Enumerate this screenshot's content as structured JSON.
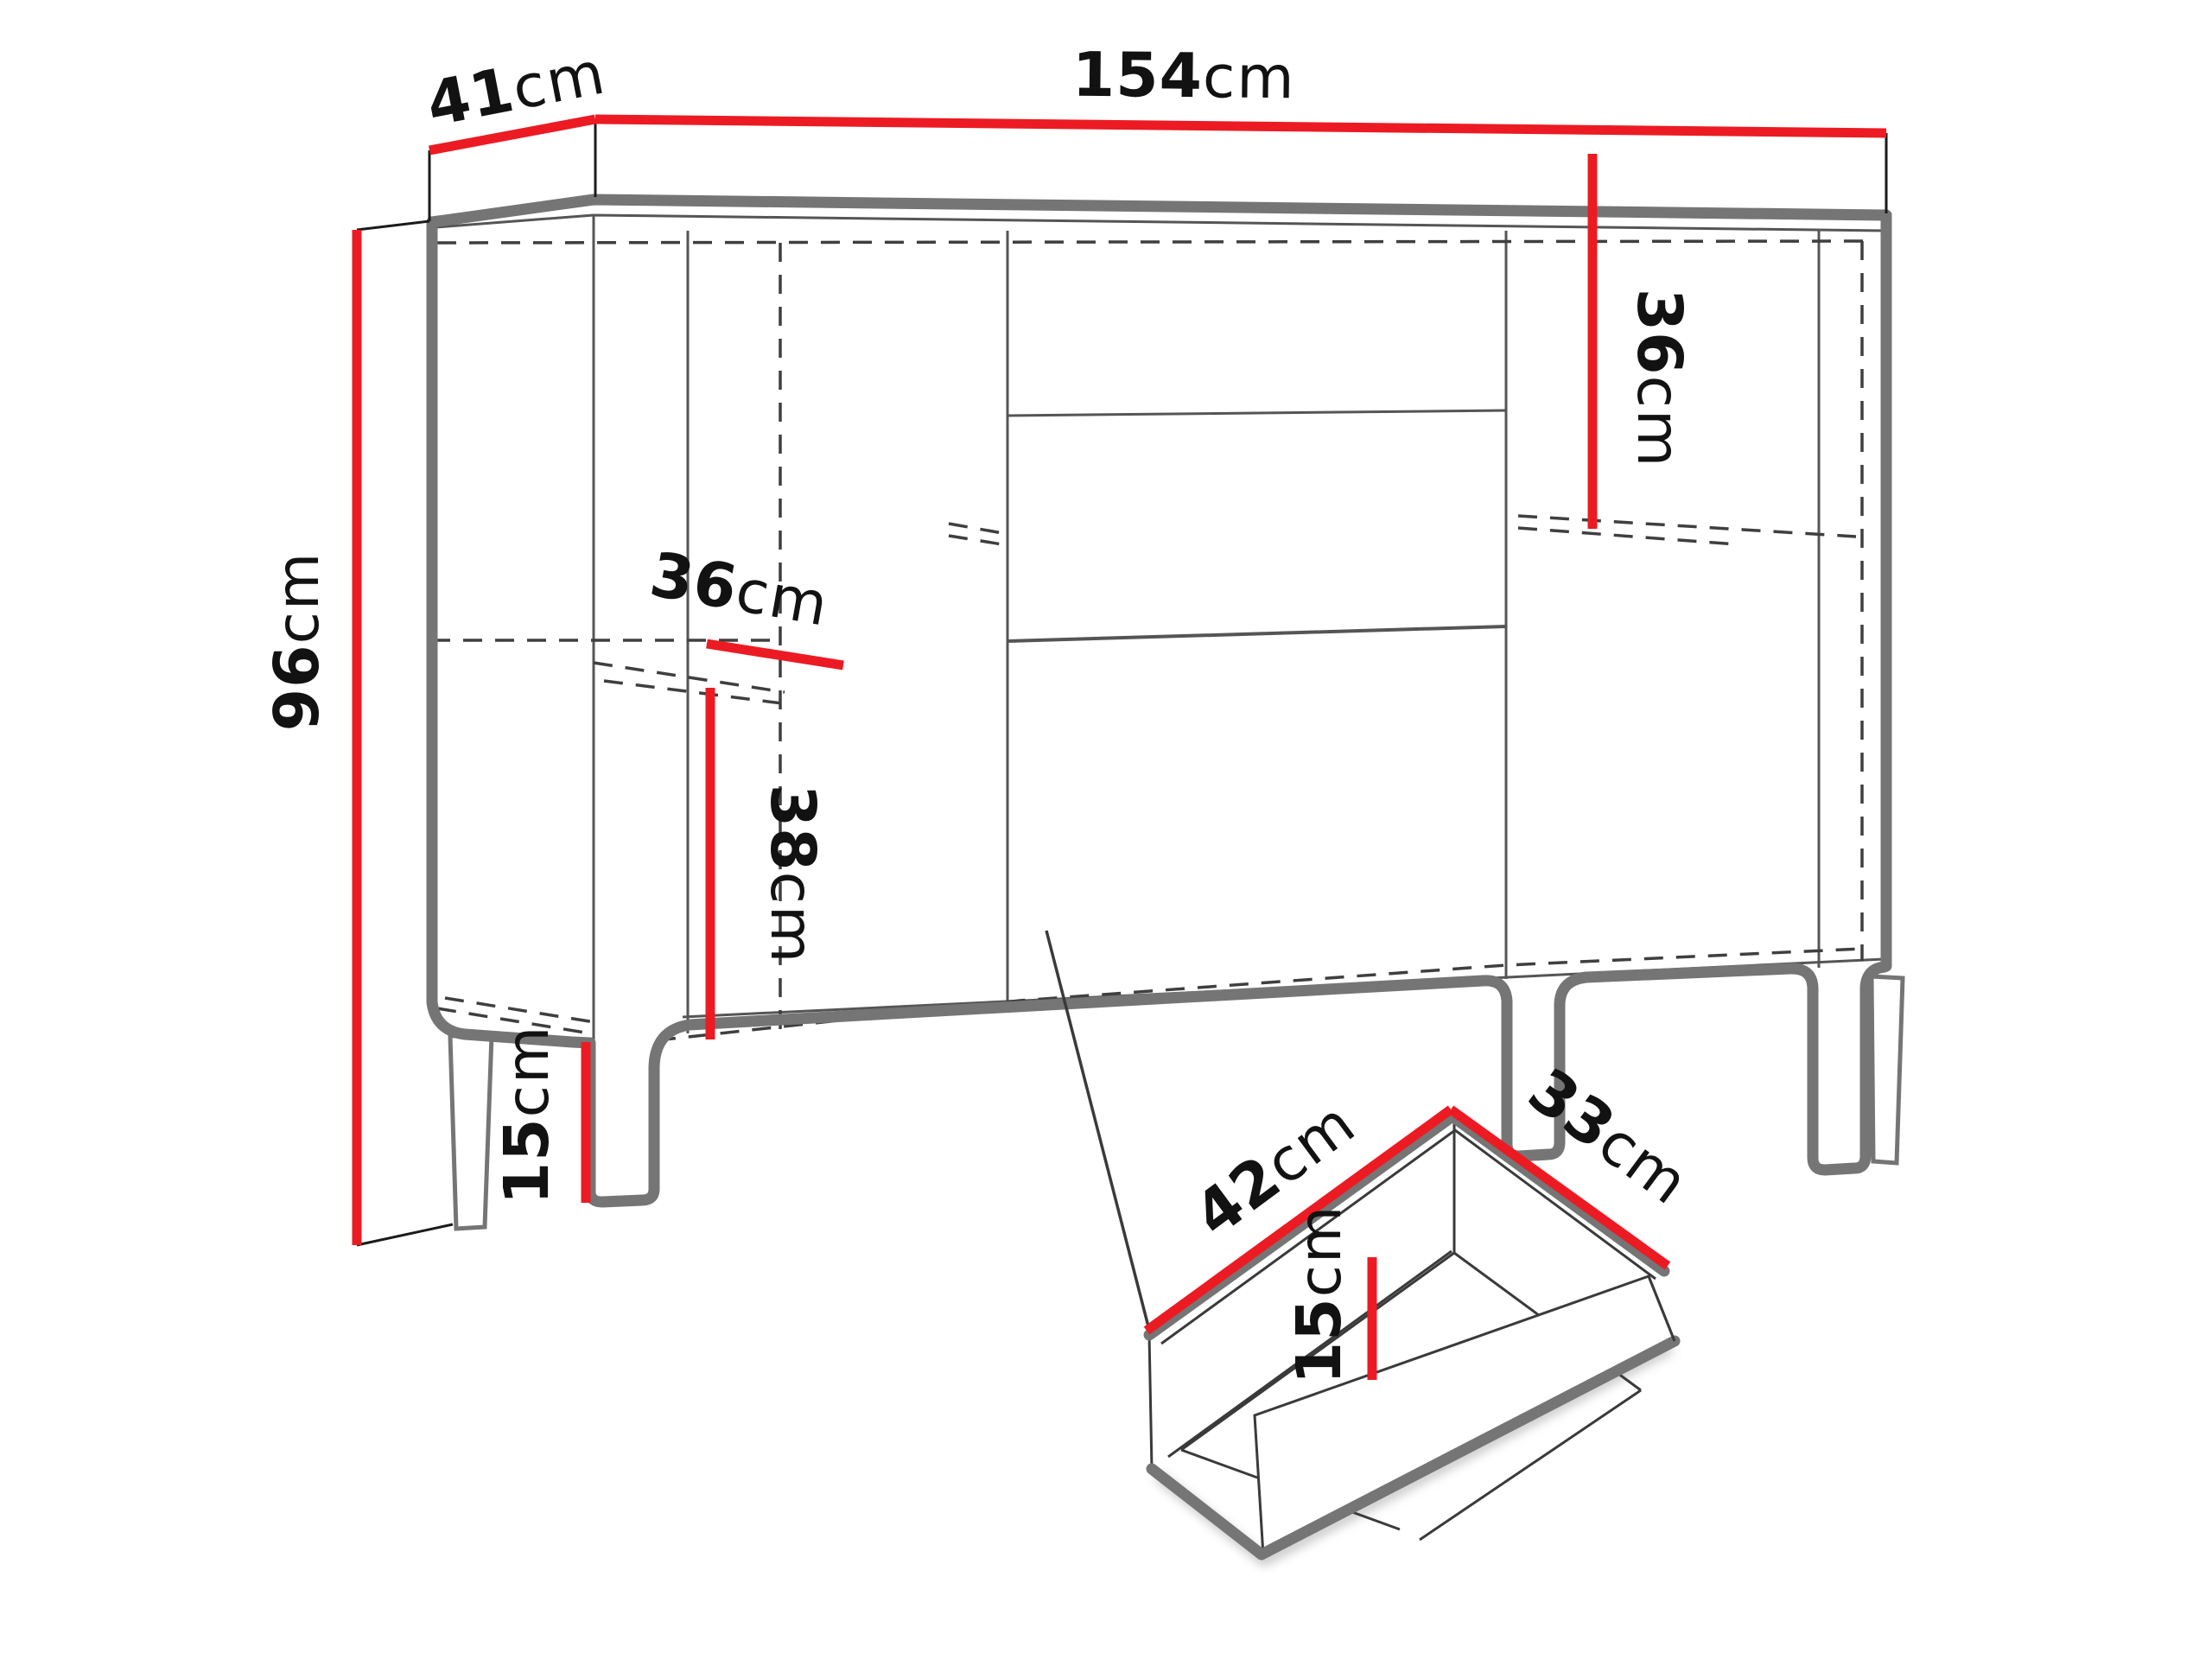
{
  "diagram": {
    "title": "cabinet-dimension-diagram",
    "colors": {
      "dimension_red": "#ec1b23",
      "outline_gray": "#757575",
      "hidden_line_dark": "#3f3f3f",
      "text_black": "#121212",
      "background": "#ffffff"
    },
    "cabinet": {
      "width": {
        "num": "154",
        "unit": "cm"
      },
      "depth": {
        "num": "41",
        "unit": "cm"
      },
      "height": {
        "num": "96",
        "unit": "cm"
      },
      "shelf_depth": {
        "num": "36",
        "unit": "cm"
      },
      "left_section_inner_height": {
        "num": "38",
        "unit": "cm"
      },
      "leg_height": {
        "num": "15",
        "unit": "cm"
      },
      "right_section_inner_height": {
        "num": "36",
        "unit": "cm"
      }
    },
    "drawer": {
      "width": {
        "num": "42",
        "unit": "cm"
      },
      "depth": {
        "num": "33",
        "unit": "cm"
      },
      "height": {
        "num": "15",
        "unit": "cm"
      }
    }
  }
}
